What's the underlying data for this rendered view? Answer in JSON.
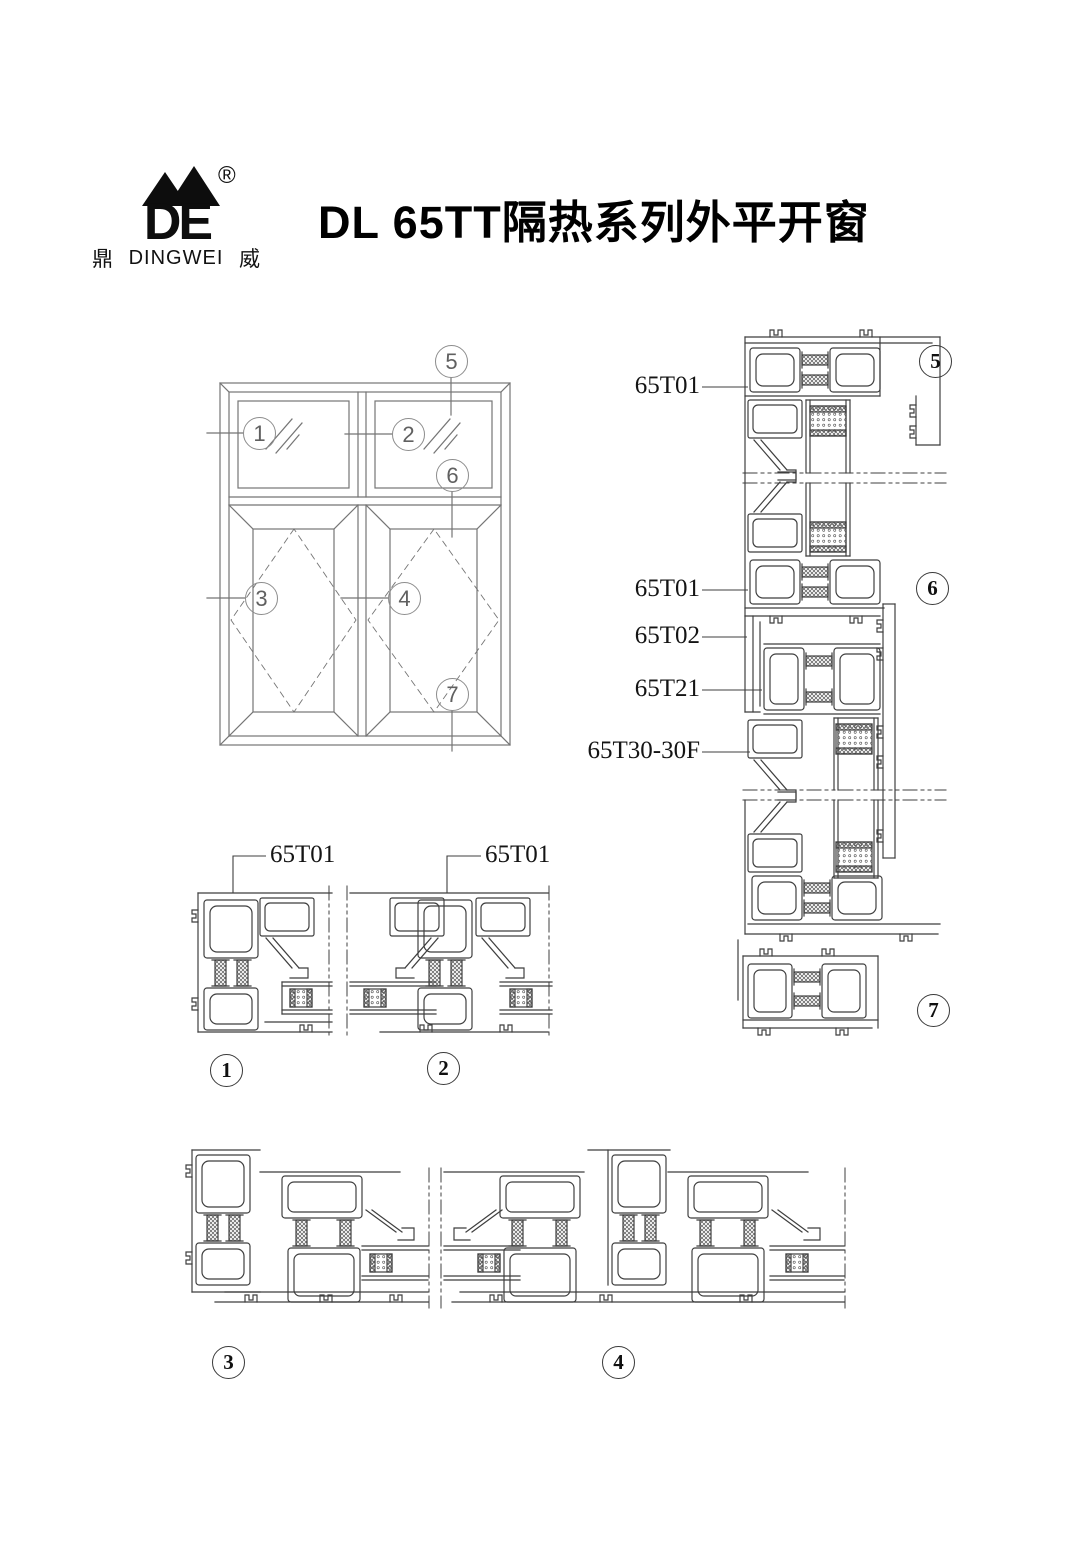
{
  "header": {
    "logo": {
      "mark": "DE",
      "registered": "®",
      "char_left": "鼎",
      "brand": "DINGWEI",
      "char_right": "威"
    },
    "title": "DL 65TT隔热系列外平开窗"
  },
  "profile_labels": {
    "stack_65t01_top": "65T01",
    "stack_65t01_mid": "65T01",
    "stack_65t02": "65T02",
    "stack_65t21": "65T21",
    "stack_65t30_30f": "65T30-30F",
    "section1": "65T01",
    "section2": "65T01"
  },
  "callouts": {
    "n1": "1",
    "n2": "2",
    "n3": "3",
    "n4": "4",
    "n5": "5",
    "n6": "6",
    "n7": "7"
  },
  "colors": {
    "line": "#3f3f3f",
    "elevation_line": "#757575",
    "text": "#111111",
    "background": "#ffffff"
  }
}
